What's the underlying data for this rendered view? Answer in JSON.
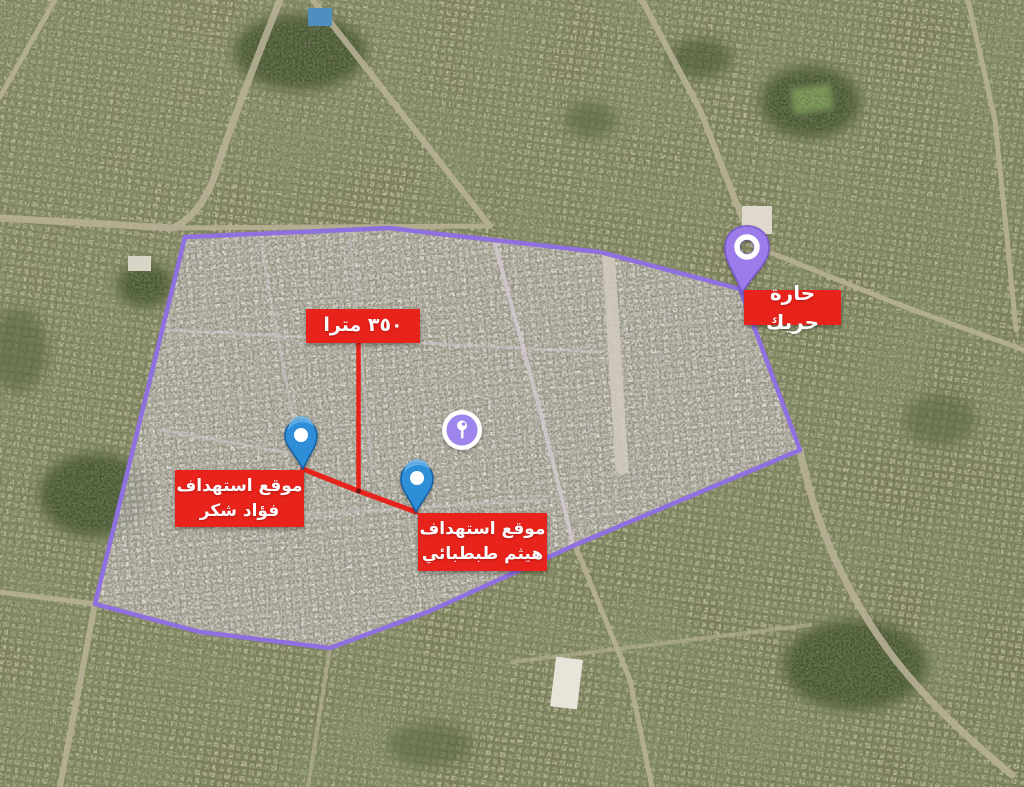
{
  "map": {
    "description_labels": {
      "region": "حارة حريك",
      "distance": "٣٥٠ مترا"
    },
    "markers": [
      {
        "id": "haret-hreik",
        "label": "حارة حريك",
        "pin_color": "#9B7CE8"
      },
      {
        "id": "fouad-shukr-strike",
        "label_line1": "موقع استهداف",
        "label_line2": "فؤاد شكر",
        "pin_color": "#2F8FD8"
      },
      {
        "id": "haytham-tabatabai-strike",
        "label_line1": "موقع استهداف",
        "label_line2": "هيثم طبطبائي",
        "pin_color": "#2F8FD8"
      }
    ],
    "colors": {
      "zone_outline": "#8F70E0",
      "annotation_red": "#E8231B",
      "label_text": "#FFFFFF",
      "center_icon_purple": "#9D85EC"
    }
  }
}
